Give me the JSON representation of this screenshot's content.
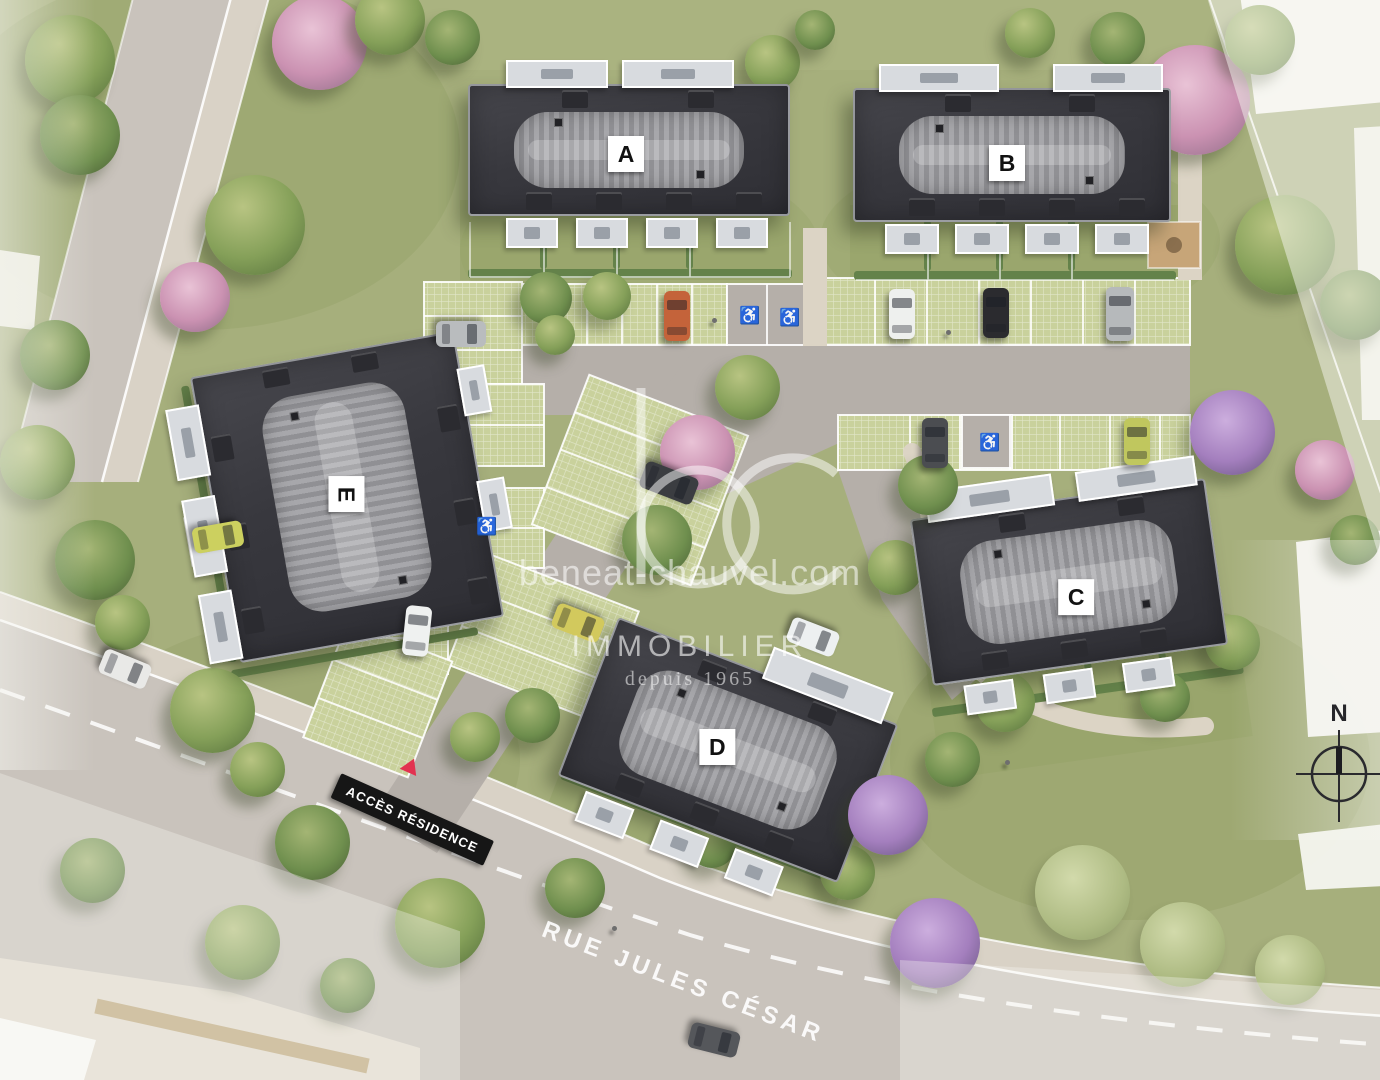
{
  "buildings": [
    {
      "id": "building-a",
      "label": "A"
    },
    {
      "id": "building-b",
      "label": "B"
    },
    {
      "id": "building-c",
      "label": "C"
    },
    {
      "id": "building-d",
      "label": "D"
    },
    {
      "id": "building-e",
      "label": "E"
    }
  ],
  "watermark": {
    "logo_text": "bc",
    "website": "beneat-chauvel.com",
    "brand": "IMMOBILIER",
    "tagline": "depuis 1965"
  },
  "signs": {
    "residence_access": "ACCÈS RÉSIDENCE",
    "street_name": "RUE JULES CÉSAR"
  },
  "compass": {
    "north_label": "N"
  },
  "icons": {
    "handicap_glyph": "♿"
  },
  "colors": {
    "roof": "#3a3a40",
    "roof_ridge": "#a0a0a4",
    "grass": "#a6af7c",
    "pavers": "#c9d19c",
    "asphalt": "#b5afa9",
    "road": "#c9c3bc",
    "sidewalk": "#d9d2c6",
    "footpath": "#dcd4c5",
    "hedge": "#64824a",
    "banner_bg": "#161616",
    "banner_text": "#ffffff",
    "access_triangle": "#e23250",
    "label_bg": "#ffffff",
    "label_text": "#121212",
    "watermark": "#ffffff"
  }
}
